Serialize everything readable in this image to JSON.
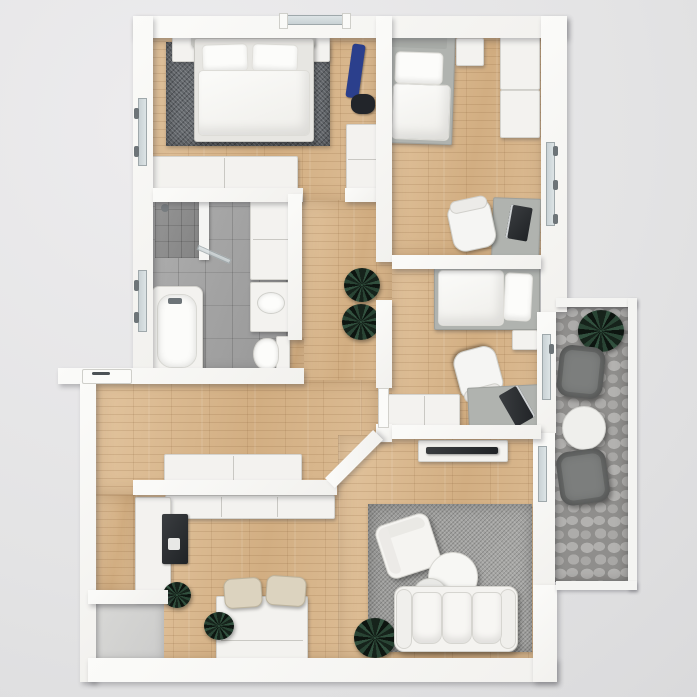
{
  "scene": {
    "title": "Apartment Floor Plan - Top-Down 3D Render",
    "view": "top-down",
    "style": "photorealistic 3d architectural render",
    "canvas_px": 697,
    "visible_text": "none"
  },
  "palette": {
    "bg": "#e3e3e4",
    "wall": "#f2f1ee",
    "wood": "#d9ba92",
    "tile": "#a4a4a4",
    "tile-dark": "#8d8d8d",
    "cobble-dark": "#8f8e8c",
    "rug-dark": "#64686c",
    "rug-light": "#a2a2a0",
    "white-furn": "#f3f2ef",
    "gray-furn": "#b0b3af",
    "dark": "#202326",
    "plant": "#31503e",
    "blue": "#2b3f8c",
    "beige": "#dcd3bf",
    "glass": "#c6cfd2",
    "metal": "#6d7478",
    "balc-chair": "#7c7e7d"
  },
  "rooms": {
    "bedroom": {
      "name": "Bedroom",
      "floor": "wood planks",
      "furniture": [
        "double bed with two pillows",
        "dark gray area rug",
        "two nightstands",
        "sideboard dresser",
        "wardrobe",
        "blue vacuum cleaner"
      ]
    },
    "kids1": {
      "name": "Kids Room 1",
      "floor": "wood planks",
      "furniture": [
        "single bed",
        "nightstand",
        "two wardrobe units",
        "desk with laptop",
        "office chair"
      ]
    },
    "kids2": {
      "name": "Kids Room 2",
      "floor": "wood planks",
      "furniture": [
        "single bed",
        "nightstand",
        "desk with laptop",
        "office chair",
        "low cabinet"
      ]
    },
    "bathroom": {
      "name": "Bathroom",
      "floor": "gray tile",
      "furniture": [
        "bathtub",
        "corner shower with glass",
        "vanity cabinets",
        "washbasin",
        "toilet"
      ]
    },
    "hallway": {
      "name": "Hallway",
      "floor": "wood planks",
      "furniture": [
        "sideboard",
        "two potted plants"
      ]
    },
    "kitchen": {
      "name": "Kitchen / Dining",
      "floor": "wood planks",
      "furniture": [
        "counter run",
        "tall dark appliance",
        "dining table",
        "two beige chairs",
        "potted plants"
      ]
    },
    "living": {
      "name": "Living Room",
      "floor": "wood planks",
      "furniture": [
        "three-seat sofa",
        "armchair",
        "two round coffee tables",
        "tv lowboard with tv",
        "gray area rug",
        "potted plant"
      ]
    },
    "balcony": {
      "name": "Balcony",
      "floor": "stone pavers",
      "furniture": [
        "two gray lounge chairs",
        "round bistro table",
        "potted plant"
      ]
    },
    "terrace": {
      "name": "Terrace Nook",
      "floor": "concrete",
      "furniture": []
    }
  },
  "openings": {
    "windows": [
      "top wall window",
      "bedroom left window",
      "bathroom left window",
      "kids room 1 right window"
    ],
    "doors": [
      "entry door with handle",
      "bedroom doorway",
      "bathroom doorway",
      "kids room doorways",
      "balcony door kids room 2",
      "balcony door living room"
    ]
  }
}
